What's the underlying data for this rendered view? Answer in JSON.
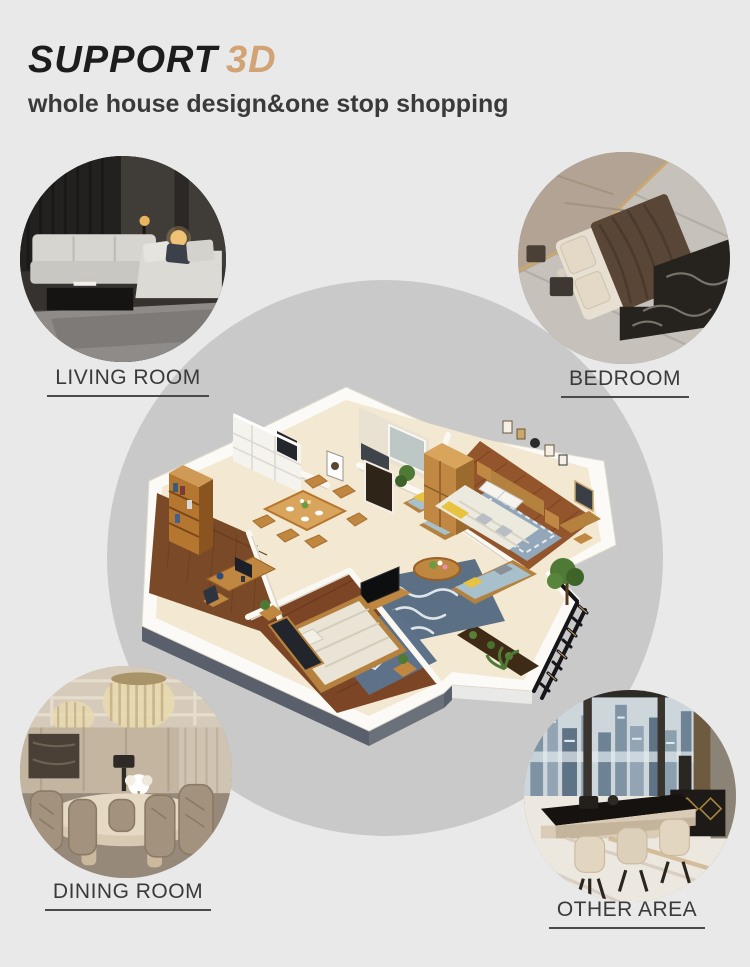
{
  "header": {
    "title_main": "SUPPORT",
    "title_accent": "3D",
    "subtitle": "whole house design&one stop shopping"
  },
  "sections": [
    {
      "id": "living-room",
      "label": "LIVING ROOM",
      "image": "living-room-photo",
      "position": "top-left"
    },
    {
      "id": "bedroom",
      "label": "BEDROOM",
      "image": "bedroom-photo",
      "position": "top-right"
    },
    {
      "id": "dining-room",
      "label": "DINING ROOM",
      "image": "dining-room-photo",
      "position": "bottom-left"
    },
    {
      "id": "other-area",
      "label": "OTHER AREA",
      "image": "other-area-photo",
      "position": "bottom-right"
    }
  ],
  "center": {
    "image": "isometric-3d-apartment-floorplan",
    "rooms": [
      "master-bedroom",
      "living-room",
      "dining-area",
      "study",
      "second-bedroom",
      "bathroom",
      "laundry",
      "balcony"
    ]
  },
  "colors": {
    "background": "#e9e9e9",
    "center_circle": "#c9c9c9",
    "accent_tan": "#d2a374",
    "title_text": "#1d1d1d",
    "label_text": "#3a3a3a"
  }
}
